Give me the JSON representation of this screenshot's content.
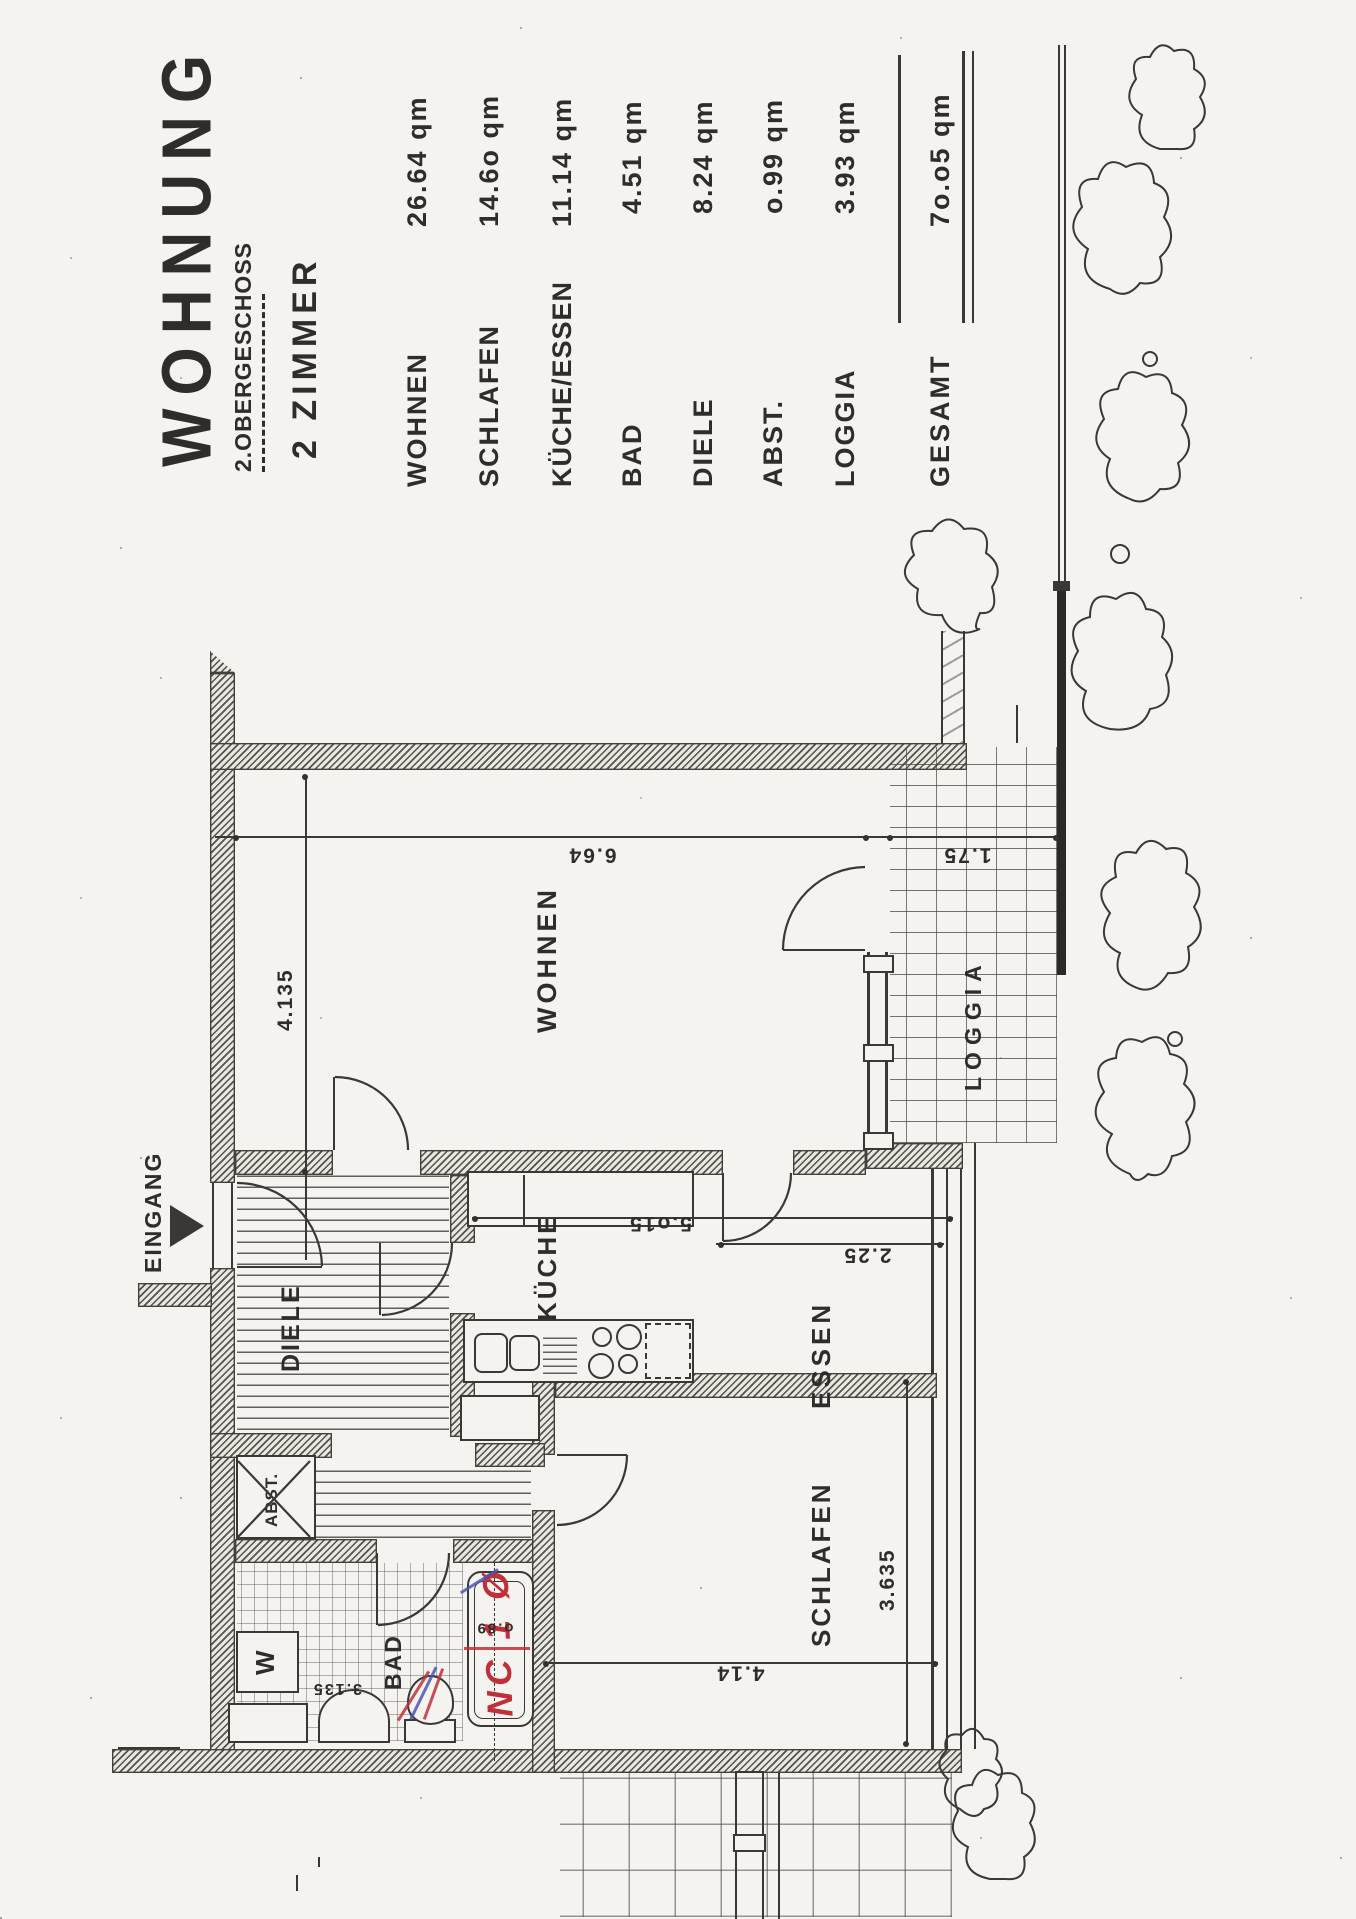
{
  "title": {
    "main": "WOHNUNG",
    "floor": "2.OBERGESCHOSS",
    "type": "2 ZIMMER"
  },
  "table": {
    "rows": [
      {
        "label": "WOHNEN",
        "area": "26.64 qm"
      },
      {
        "label": "SCHLAFEN",
        "area": "14.6o qm"
      },
      {
        "label": "KÜCHE/ESSEN",
        "area": "11.14 qm"
      },
      {
        "label": "BAD",
        "area": "4.51 qm"
      },
      {
        "label": "DIELE",
        "area": "8.24 qm"
      },
      {
        "label": "ABST.",
        "area": "o.99 qm"
      },
      {
        "label": "LOGGIA",
        "area": "3.93 qm"
      }
    ],
    "total": {
      "label": "GESAMT",
      "area": "7o.o5 qm"
    }
  },
  "plan": {
    "labels": {
      "wohnen": "WOHNEN",
      "kueche": "KÜCHE",
      "essen": "ESSEN",
      "diele": "DIELE",
      "schlafen": "SCHLAFEN",
      "bad": "BAD",
      "abst": "ABST.",
      "loggia": "LOGGIA",
      "eingang": "EINGANG",
      "washer": "W"
    },
    "dims": {
      "wohnen_w": "4.135",
      "wohnen_h": "6.64",
      "loggia_d": "1.75",
      "kueche_essen_h": "5.o15",
      "essen_h": "2.25",
      "schlafen_w": "3.635",
      "schlafen_h": "4.14",
      "bad_h": "3.135",
      "tub": "o.89"
    },
    "annotations": {
      "red_mark": "NC 1 Ø"
    }
  },
  "colors": {
    "paper": "#f5f3ef",
    "ink": "#2e2d2b",
    "red": "#c0303a",
    "blue": "#4a55b5"
  }
}
